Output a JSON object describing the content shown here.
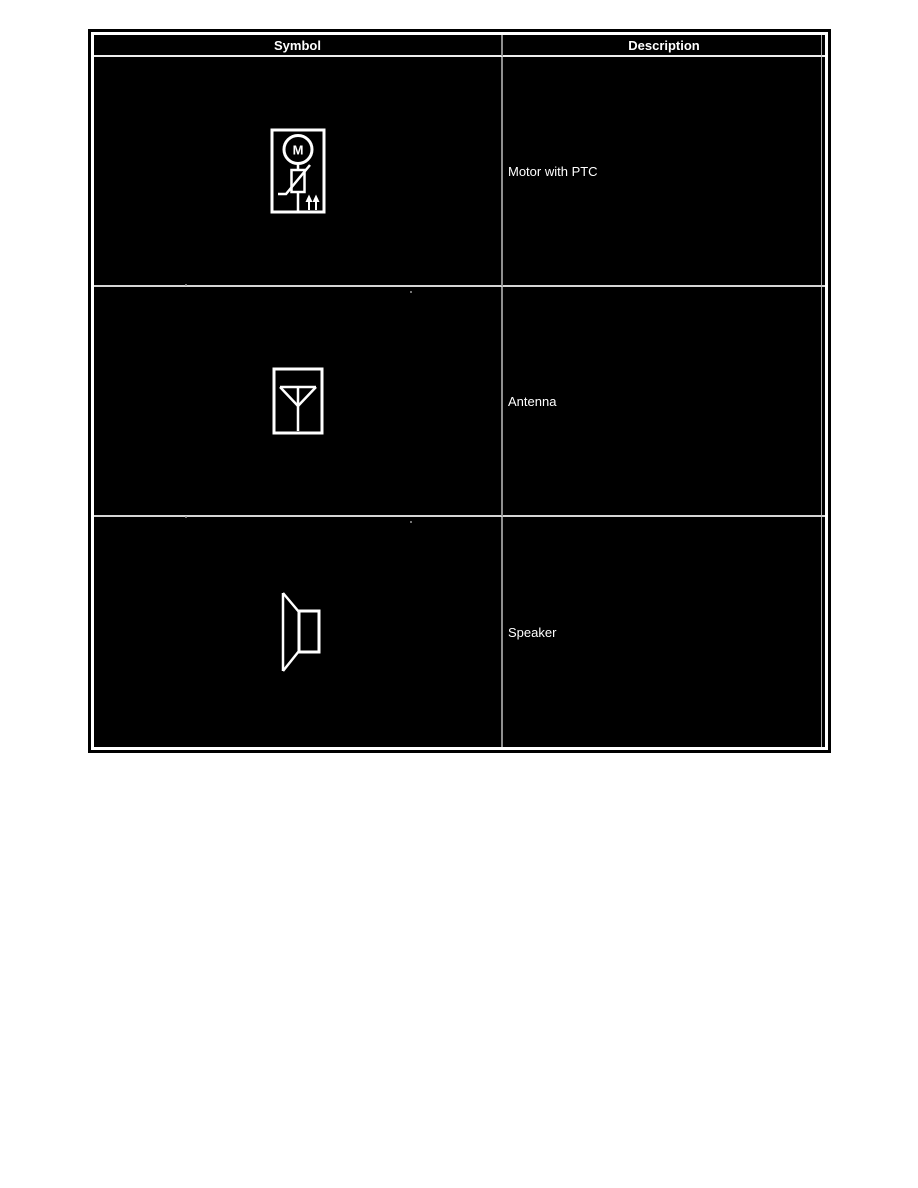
{
  "document": {
    "type": "wiring-diagram-symbol-legend"
  },
  "header": {
    "symbol_col": "Symbol",
    "description_col": "Description"
  },
  "rows": [
    {
      "symbol_name": "motor-with-ptc",
      "description": "Motor with PTC"
    },
    {
      "symbol_name": "antenna",
      "description": "Antenna"
    },
    {
      "symbol_name": "speaker",
      "description": "Speaker"
    }
  ],
  "symbols": {
    "motor_letter": "M"
  },
  "colors": {
    "page_background": "#ffffff",
    "table_background": "#000000",
    "frame_border": "#ffffff",
    "text": "#ffffff",
    "column_divider": "#8f8f8f",
    "row_divider": "#d4d4d4",
    "header_divider": "#ededed"
  }
}
